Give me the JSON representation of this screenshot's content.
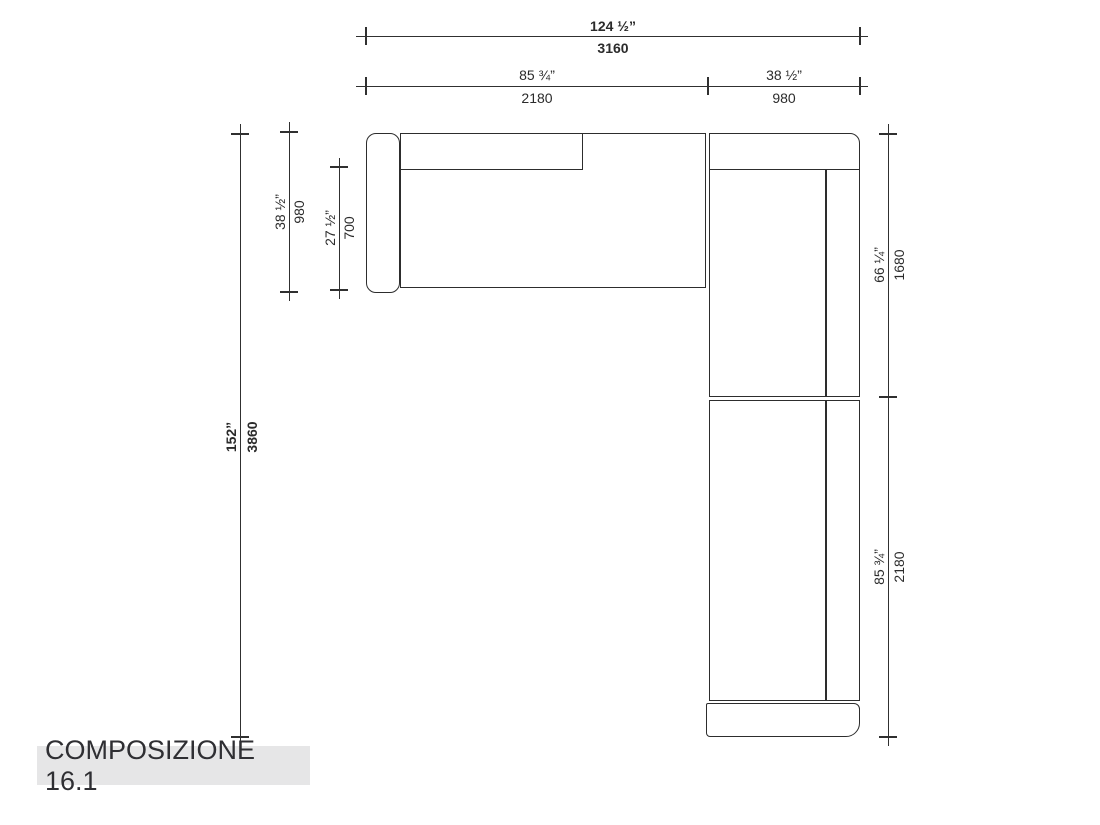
{
  "title": "COMPOSIZIONE 16.1",
  "dims": {
    "overall_width_in": "124 ½”",
    "overall_width_mm": "3160",
    "seat_width_in": "85 ¾”",
    "seat_width_mm": "2180",
    "corner_width_in": "38 ½”",
    "corner_width_mm": "980",
    "overall_depth_in": "152”",
    "overall_depth_mm": "3860",
    "left_depth_in": "38 ½”",
    "left_depth_mm": "980",
    "seat_depth_in": "27 ½”",
    "seat_depth_mm": "700",
    "right_upper_in": "66 ¼”",
    "right_upper_mm": "1680",
    "right_lower_in": "85 ¾”",
    "right_lower_mm": "2180"
  },
  "colors": {
    "line": "#2d2d2d",
    "title_bg": "#e6e6e7",
    "title_text": "#2f2f33",
    "background": "#ffffff"
  }
}
